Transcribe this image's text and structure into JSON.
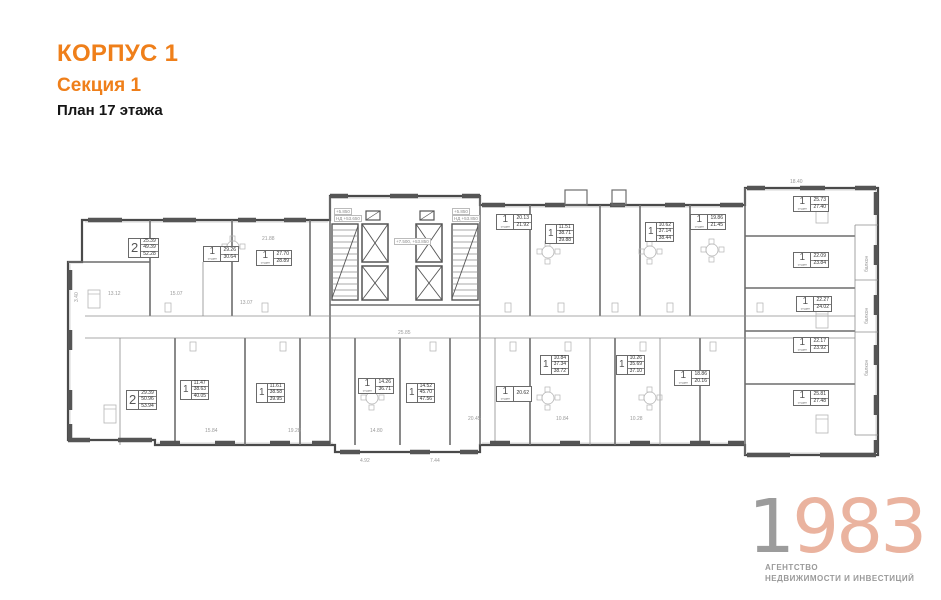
{
  "header": {
    "building": "КОРПУС 1",
    "section": "Секция 1",
    "floor": "План 17 этажа"
  },
  "logo": {
    "year_prefix": "1",
    "year_rest": "983",
    "line1": "АГЕНТСТВО",
    "line2": "НЕДВИЖИМОСТИ И ИНВЕСТИЦИЙ",
    "color_prefix": "#9c9c9c",
    "color_rest": "#eab39f",
    "text_color": "#9a9a9a"
  },
  "colors": {
    "accent_orange": "#ef7f1a",
    "plan_dark": "#4a4a4a",
    "plan_mid": "#8c8c8c",
    "plan_light": "#c9c9c9"
  },
  "plan": {
    "units": [
      {
        "type": "2",
        "areas": [
          "25.39",
          "49.39",
          "52.28"
        ],
        "x": 128,
        "y": 238
      },
      {
        "type": "1",
        "sub": "студия",
        "areas": [
          "29.26",
          "30.64"
        ],
        "x": 203,
        "y": 246
      },
      {
        "type": "1",
        "sub": "студия",
        "areas": [
          "27.70",
          "28.89"
        ],
        "x": 256,
        "y": 250
      },
      {
        "type": "1",
        "sub": "студия",
        "areas": [
          "20.13",
          "21.92"
        ],
        "x": 496,
        "y": 214
      },
      {
        "type": "1",
        "areas": [
          "11.51",
          "38.71",
          "39.88"
        ],
        "x": 545,
        "y": 224
      },
      {
        "type": "1",
        "areas": [
          "10.62",
          "37.14",
          "38.44"
        ],
        "x": 645,
        "y": 222
      },
      {
        "type": "1",
        "sub": "студия",
        "areas": [
          "19.86",
          "21.45"
        ],
        "x": 690,
        "y": 214
      },
      {
        "type": "1",
        "sub": "студия",
        "areas": [
          "25.73",
          "27.40"
        ],
        "x": 793,
        "y": 196
      },
      {
        "type": "1",
        "sub": "студия",
        "areas": [
          "22.09",
          "23.84"
        ],
        "x": 793,
        "y": 252
      },
      {
        "type": "1",
        "sub": "студия",
        "areas": [
          "22.27",
          "24.02"
        ],
        "x": 796,
        "y": 296
      },
      {
        "type": "1",
        "sub": "студия",
        "areas": [
          "22.17",
          "23.92"
        ],
        "x": 793,
        "y": 337
      },
      {
        "type": "1",
        "sub": "студия",
        "areas": [
          "25.81",
          "27.48"
        ],
        "x": 793,
        "y": 390
      },
      {
        "type": "1",
        "areas": [
          "10.84",
          "37.34",
          "38.72"
        ],
        "x": 540,
        "y": 355
      },
      {
        "type": "1",
        "areas": [
          "10.26",
          "35.69",
          "37.10"
        ],
        "x": 616,
        "y": 355
      },
      {
        "type": "1",
        "sub": "студия",
        "areas": [
          "18.86",
          "20.16"
        ],
        "x": 674,
        "y": 370
      },
      {
        "type": "1",
        "sub": "студия",
        "areas": [
          "20.62"
        ],
        "x": 496,
        "y": 386
      },
      {
        "type": "1",
        "areas": [
          "14.52",
          "45.70",
          "47.56"
        ],
        "x": 406,
        "y": 383
      },
      {
        "type": "1",
        "sub": "студия",
        "areas": [
          "14.26",
          "36.71"
        ],
        "x": 358,
        "y": 378
      },
      {
        "type": "1",
        "areas": [
          "11.61",
          "38.58",
          "39.95"
        ],
        "x": 256,
        "y": 383
      },
      {
        "type": "1",
        "areas": [
          "11.47",
          "38.63",
          "40.05"
        ],
        "x": 180,
        "y": 380
      },
      {
        "type": "2",
        "areas": [
          "29.39",
          "50.96",
          "53.94"
        ],
        "x": 126,
        "y": 390
      }
    ],
    "core_labels": [
      {
        "t": "+5.850",
        "x": 334,
        "y": 208
      },
      {
        "t": "НД +53.650",
        "x": 334,
        "y": 215
      },
      {
        "t": "+7.500, +53.850",
        "x": 394,
        "y": 238
      },
      {
        "t": "+5.850",
        "x": 452,
        "y": 208
      },
      {
        "t": "НД +53.850",
        "x": 452,
        "y": 215
      }
    ],
    "balcony_labels": [
      {
        "t": "балкон",
        "x": 864,
        "y": 272
      },
      {
        "t": "балкон",
        "x": 864,
        "y": 324
      },
      {
        "t": "балкон",
        "x": 864,
        "y": 376
      }
    ],
    "dimensions": [
      {
        "t": "3.40",
        "x": 74,
        "y": 302,
        "r": -90
      },
      {
        "t": "13.12",
        "x": 108,
        "y": 291
      },
      {
        "t": "15.07",
        "x": 170,
        "y": 291
      },
      {
        "t": "21.88",
        "x": 262,
        "y": 236
      },
      {
        "t": "25.85",
        "x": 398,
        "y": 330
      },
      {
        "t": "13.07",
        "x": 240,
        "y": 300
      },
      {
        "t": "15.84",
        "x": 205,
        "y": 428
      },
      {
        "t": "19.28",
        "x": 288,
        "y": 428
      },
      {
        "t": "14.80",
        "x": 370,
        "y": 428
      },
      {
        "t": "20.45",
        "x": 468,
        "y": 416
      },
      {
        "t": "10.84",
        "x": 556,
        "y": 416
      },
      {
        "t": "10.28",
        "x": 630,
        "y": 416
      },
      {
        "t": "4.92",
        "x": 360,
        "y": 458
      },
      {
        "t": "7.44",
        "x": 430,
        "y": 458
      },
      {
        "t": "18.40",
        "x": 790,
        "y": 179
      }
    ]
  }
}
